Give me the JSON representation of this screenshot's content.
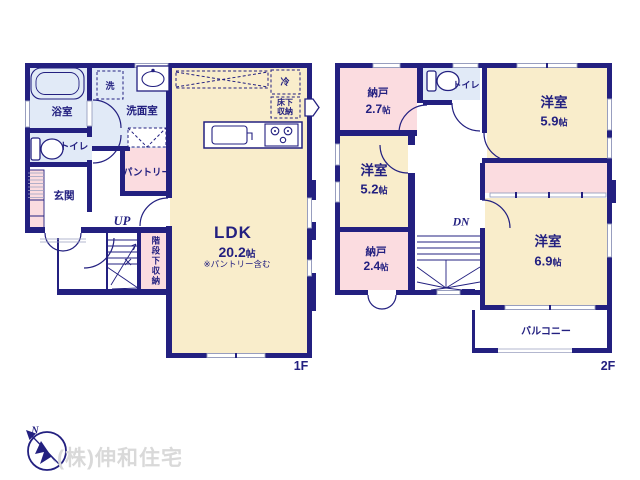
{
  "watermark": "(株)伸和住宅",
  "compass": {
    "label": "N"
  },
  "colors": {
    "wall_navy": "#232080",
    "room_cream": "#f9edcb",
    "room_pink": "#fbdce0",
    "room_blue": "#e1eaf7",
    "watermark_gray": "#d9d9d9"
  },
  "floor1": {
    "floor_label": "1F",
    "stair_direction": "UP",
    "rooms": {
      "bath": {
        "name": "浴室"
      },
      "washer": {
        "name": "洗"
      },
      "washroom": {
        "name": "洗面室"
      },
      "toilet": {
        "name": "トイレ"
      },
      "entrance": {
        "name": "玄関"
      },
      "pantry": {
        "name": "パントリー"
      },
      "under_stair_storage": {
        "name": "階段下収納"
      },
      "fridge": {
        "name": "冷"
      },
      "underfloor_storage": {
        "line1": "床下",
        "line2": "収納"
      },
      "ldk": {
        "name": "LDK",
        "size": "20.2",
        "unit": "帖",
        "note": "※パントリー含む"
      }
    }
  },
  "floor2": {
    "floor_label": "2F",
    "stair_direction": "DN",
    "rooms": {
      "storage_a": {
        "name": "納戸",
        "size": "2.7",
        "unit": "帖"
      },
      "toilet": {
        "name": "トイレ"
      },
      "bedroom_a": {
        "name": "洋室",
        "size": "5.9",
        "unit": "帖"
      },
      "bedroom_b": {
        "name": "洋室",
        "size": "5.2",
        "unit": "帖"
      },
      "storage_b": {
        "name": "納戸",
        "size": "2.4",
        "unit": "帖"
      },
      "bedroom_c": {
        "name": "洋室",
        "size": "6.9",
        "unit": "帖"
      },
      "balcony": {
        "name": "バルコニー"
      }
    }
  }
}
